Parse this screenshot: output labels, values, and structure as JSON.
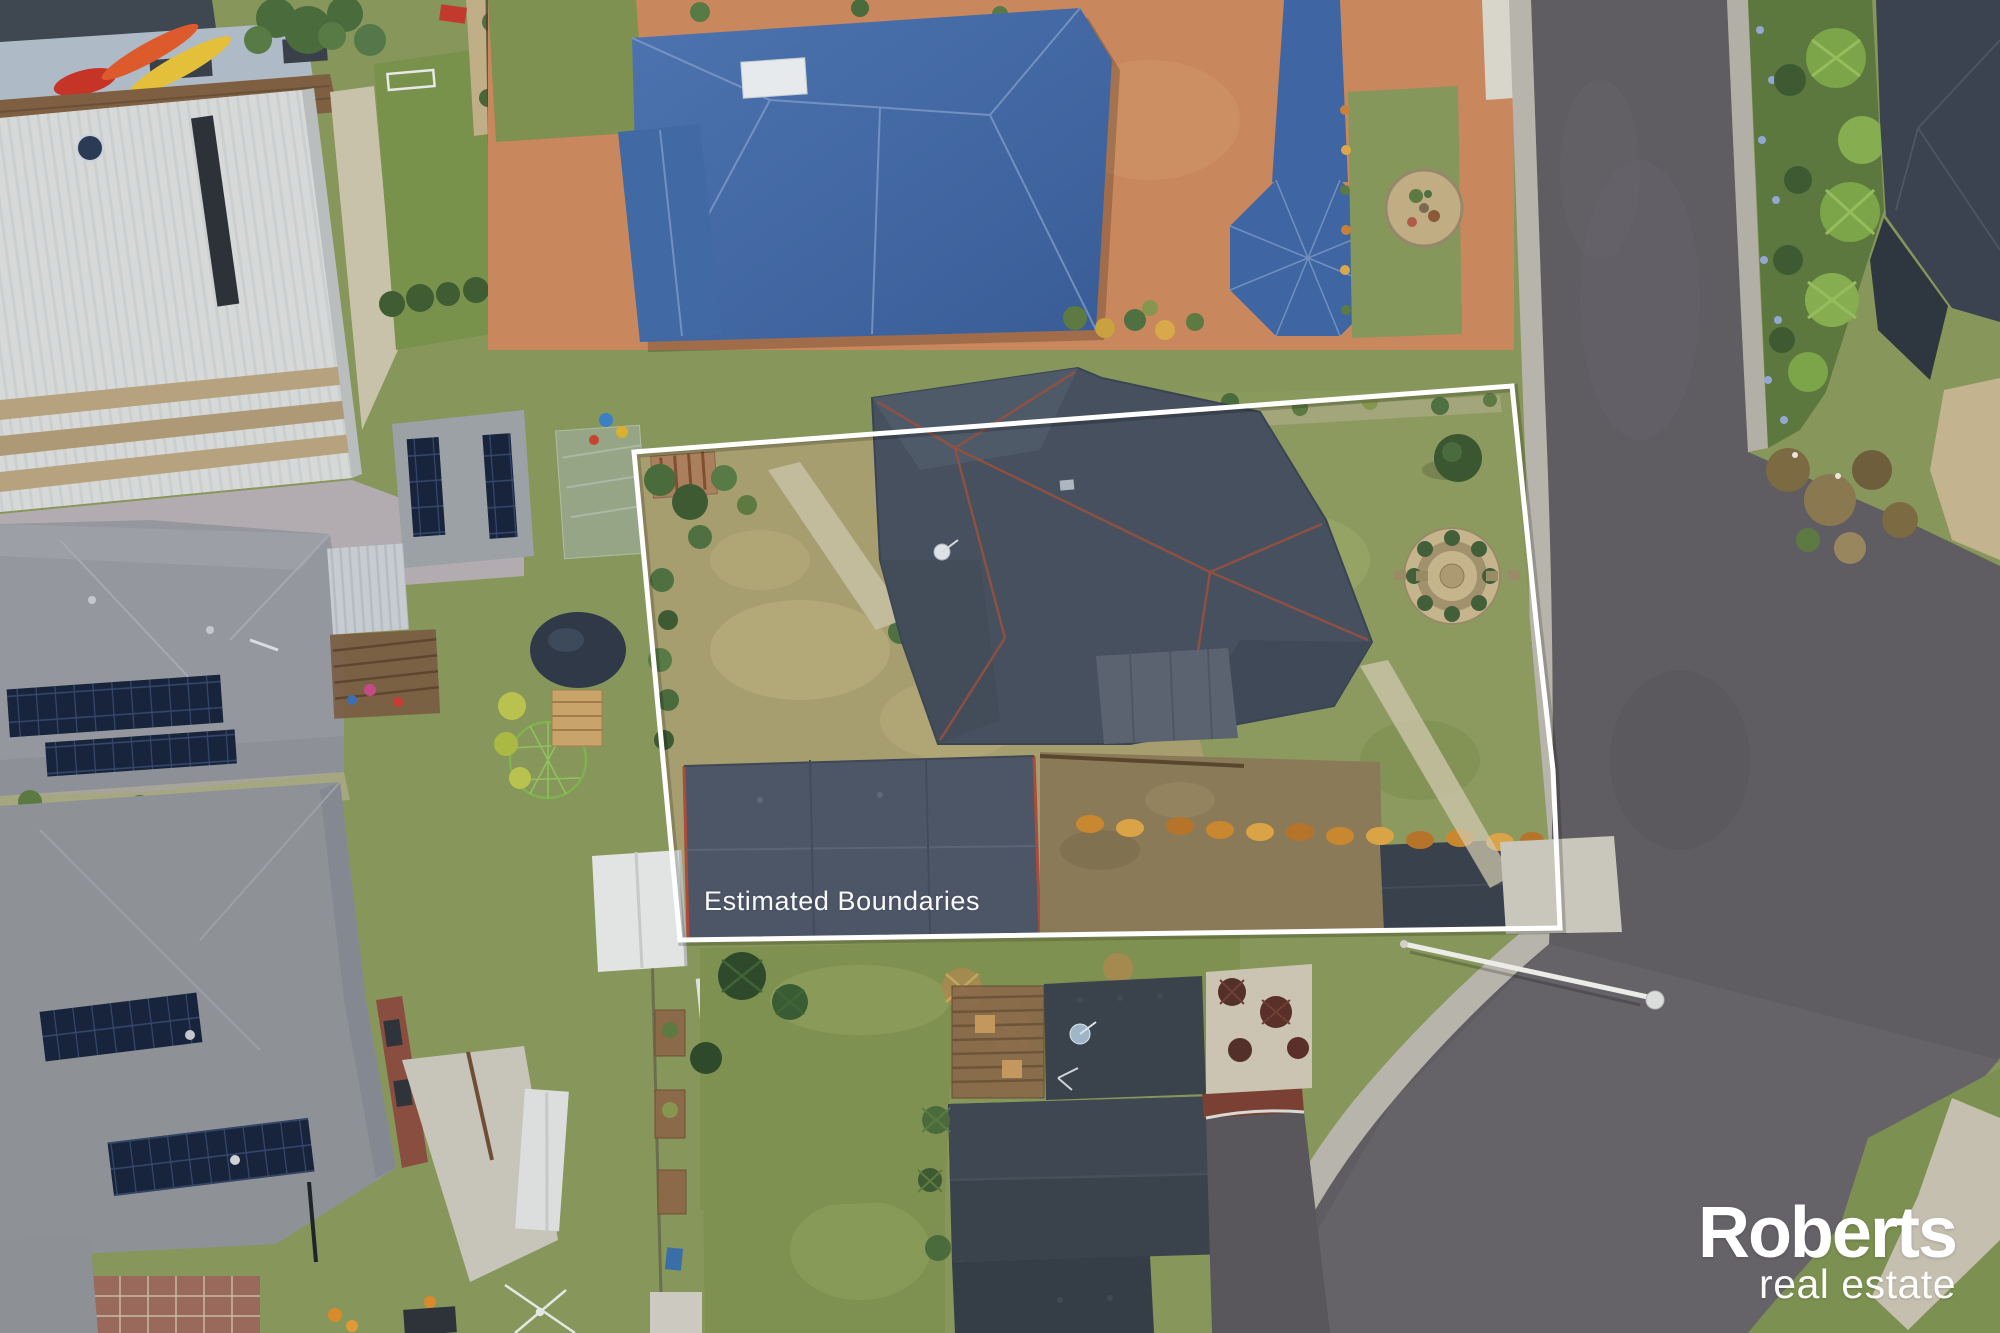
{
  "overlay": {
    "boundary_label": "Estimated Boundaries"
  },
  "watermark": {
    "name": "Roberts",
    "suffix": "real estate"
  },
  "palette": {
    "boundary_line": "#ffffff",
    "watermark_text": "#ffffff",
    "blue_roof": "#3f66a3",
    "terracotta_paving": "#c8875c",
    "subject_slate_roof": "#46505e",
    "shed_roof": "#4d5666",
    "charcoal_roof": "#3a424c",
    "asphalt_road": "#5f5d62",
    "concrete_path": "#b7b4ab",
    "dry_lawn": "#a79e6f",
    "green_lawn": "#7f9150",
    "white_metal_roof": "#d6d8d8",
    "solar_panel": "#18233c",
    "ridge_capping_red": "#96503f"
  }
}
